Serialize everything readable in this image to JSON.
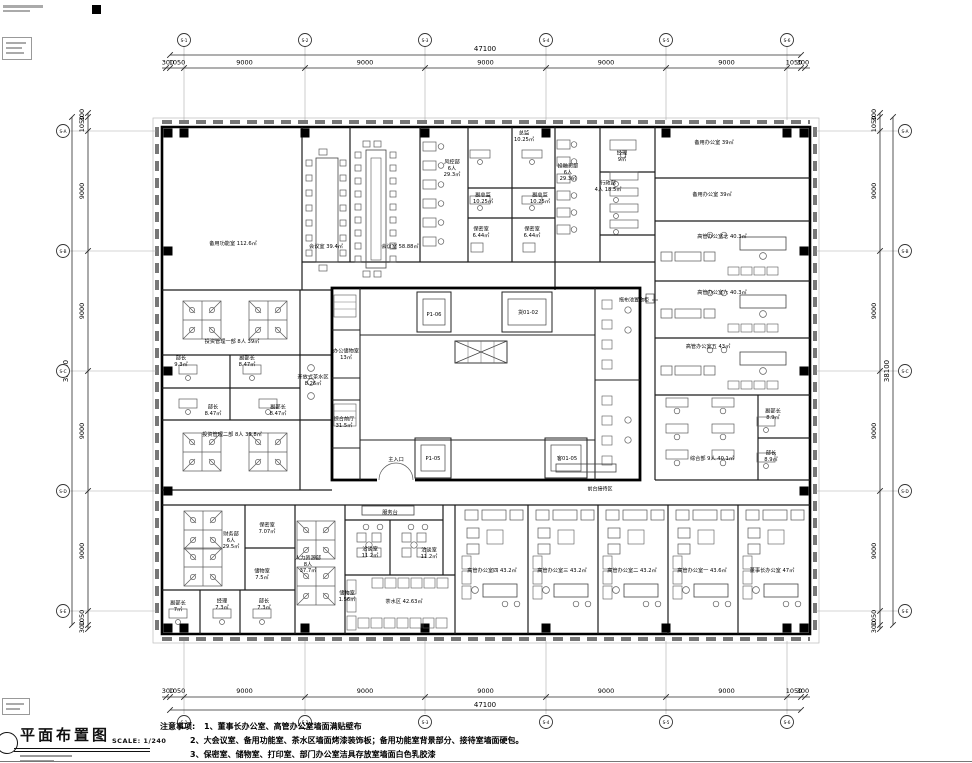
{
  "meta": {
    "title": "平面布置图",
    "scale": "SCALE: 1/240"
  },
  "notes": {
    "heading": "注意事项:",
    "lines": [
      "1、董事长办公室、高管办公室墙面满贴壁布",
      "2、大会议室、备用功能室、茶水区墙面烤漆装饰板；备用功能室背景部分、接待室墙面硬包。",
      "3、保密室、储物室、打印室、部门办公室洁具存放室墙面白色乳胶漆"
    ]
  },
  "dims": {
    "top": {
      "total": "47100",
      "segments": [
        "300",
        "1050",
        "9000",
        "9000",
        "9000",
        "9000",
        "9000",
        "1050",
        "300"
      ]
    },
    "bottom": {
      "total": "47100",
      "segments": [
        "300",
        "1050",
        "9000",
        "9000",
        "9000",
        "9000",
        "9000",
        "1050",
        "300"
      ]
    },
    "left": {
      "total": "38100",
      "segments": [
        "300",
        "1050",
        "9000",
        "9000",
        "9000",
        "9000",
        "1050",
        "300"
      ]
    },
    "right": {
      "total": "38100",
      "segments": [
        "300",
        "1050",
        "9000",
        "9000",
        "9000",
        "9000",
        "1050",
        "300"
      ]
    }
  },
  "axes": {
    "horizontal": [
      "S-1",
      "S-2",
      "S-3",
      "S-4",
      "S-5",
      "S-6"
    ],
    "vertical": [
      "S-A",
      "S-B",
      "S-C",
      "S-D",
      "S-E"
    ]
  },
  "colors": {
    "wall": "#000000",
    "partition": "#1c1c1c",
    "furniture": "#5c5c5c",
    "dim": "#2a2a2a",
    "glazing": "#777777",
    "background": "#ffffff"
  },
  "rooms": [
    {
      "t": "备用功能室 112.6㎡",
      "x": 233,
      "y": 243
    },
    {
      "t": "会议室 39.4㎡",
      "x": 326,
      "y": 246
    },
    {
      "t": "会议室 58.88㎡",
      "x": 400,
      "y": 246
    },
    {
      "t": "风控部\n6人\n29.3㎡",
      "x": 452,
      "y": 168
    },
    {
      "t": "总监\n10.25㎡",
      "x": 524,
      "y": 136
    },
    {
      "t": "副总监\n10.25㎡",
      "x": 483,
      "y": 198
    },
    {
      "t": "副总监\n10.25㎡",
      "x": 540,
      "y": 198
    },
    {
      "t": "保密室\n6.44㎡",
      "x": 481,
      "y": 232
    },
    {
      "t": "保密室\n6.44㎡",
      "x": 532,
      "y": 232
    },
    {
      "t": "投融资部\n6人\n29.3㎡",
      "x": 568,
      "y": 172
    },
    {
      "t": "经理\n9㎡",
      "x": 622,
      "y": 156
    },
    {
      "t": "行政部\n4人 18.5㎡",
      "x": 608,
      "y": 186
    },
    {
      "t": "备用办公室 39㎡",
      "x": 714,
      "y": 142
    },
    {
      "t": "备用办公室 39㎡",
      "x": 712,
      "y": 194
    },
    {
      "t": "高管办公室七  40.3㎡",
      "x": 722,
      "y": 236
    },
    {
      "t": "高管办公室六  40.3㎡",
      "x": 722,
      "y": 292
    },
    {
      "t": "高管办公室五  43㎡",
      "x": 708,
      "y": 346
    },
    {
      "t": "综合部 9人 40.1㎡",
      "x": 712,
      "y": 458
    },
    {
      "t": "副部长\n8.9㎡",
      "x": 773,
      "y": 414
    },
    {
      "t": "部长\n8.9㎡",
      "x": 771,
      "y": 456
    },
    {
      "t": "投资管理一部 8人 39㎡",
      "x": 232,
      "y": 341
    },
    {
      "t": "部长\n9.3㎡",
      "x": 181,
      "y": 361
    },
    {
      "t": "副部长\n8.47㎡",
      "x": 247,
      "y": 361
    },
    {
      "t": "部长\n8.47㎡",
      "x": 213,
      "y": 410
    },
    {
      "t": "副部长\n8.47㎡",
      "x": 278,
      "y": 410
    },
    {
      "t": "开放式茶水区\n8.26㎡",
      "x": 313,
      "y": 380
    },
    {
      "t": "投资管理二部 8人 39.8㎡",
      "x": 232,
      "y": 434
    },
    {
      "t": "办公储物室\n13㎡",
      "x": 346,
      "y": 354
    },
    {
      "t": "综合前厅\n31.5㎡",
      "x": 344,
      "y": 422
    },
    {
      "t": "主入口",
      "x": 396,
      "y": 459
    },
    {
      "t": "P1-06",
      "x": 434,
      "y": 314
    },
    {
      "t": "货01-02",
      "x": 528,
      "y": 312
    },
    {
      "t": "P1-05",
      "x": 433,
      "y": 458
    },
    {
      "t": "客01-05",
      "x": 567,
      "y": 458
    },
    {
      "t": "财务部\n6人\n29.5㎡",
      "x": 231,
      "y": 540
    },
    {
      "t": "保密室\n7.07㎡",
      "x": 267,
      "y": 528
    },
    {
      "t": "储物室\n7.5㎡",
      "x": 262,
      "y": 574
    },
    {
      "t": "副部长\n7㎡",
      "x": 178,
      "y": 606
    },
    {
      "t": "经理\n7.3㎡",
      "x": 222,
      "y": 604
    },
    {
      "t": "部长\n7.3㎡",
      "x": 264,
      "y": 604
    },
    {
      "t": "人力资源部\n8人\n37.7㎡",
      "x": 308,
      "y": 564
    },
    {
      "t": "服务台",
      "x": 390,
      "y": 512
    },
    {
      "t": "洽谈室\n11.2㎡",
      "x": 370,
      "y": 552
    },
    {
      "t": "洽谈室\n11.2㎡",
      "x": 429,
      "y": 553
    },
    {
      "t": "储物室\n1.56㎡",
      "x": 347,
      "y": 596
    },
    {
      "t": "茶水区  42.63㎡",
      "x": 404,
      "y": 601
    },
    {
      "t": "高管办公室四  43.2㎡",
      "x": 492,
      "y": 570
    },
    {
      "t": "高管办公室三  43.2㎡",
      "x": 562,
      "y": 570
    },
    {
      "t": "高管办公室二  43.2㎡",
      "x": 632,
      "y": 570
    },
    {
      "t": "高管办公室一  43.6㎡",
      "x": 702,
      "y": 570
    },
    {
      "t": "董事长办公室  47㎡",
      "x": 772,
      "y": 570
    }
  ],
  "annotations": [
    {
      "t": "拖布池置物柜",
      "x": 634,
      "y": 300
    },
    {
      "t": "前台接待区",
      "x": 600,
      "y": 489
    }
  ]
}
